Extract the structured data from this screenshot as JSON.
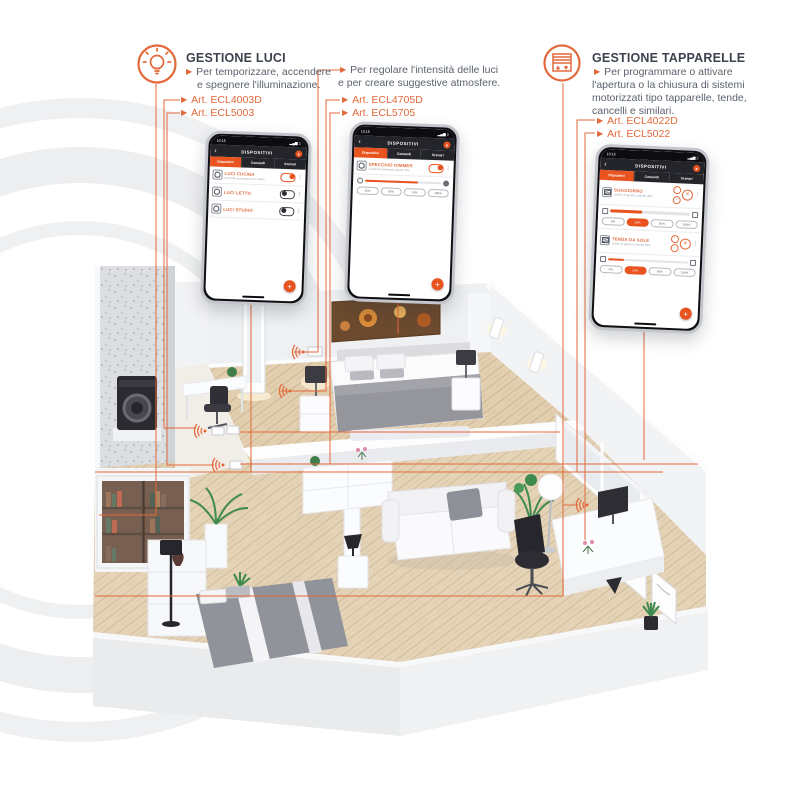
{
  "colors": {
    "accent": "#e2693b",
    "app_orange": "#e8531f",
    "dark_ui": "#24252b"
  },
  "callout_luci": {
    "title": "GESTIONE LUCI",
    "line1": "Per temporizzare, accendere",
    "line2": "e spegnere l'illuminazione.",
    "articles": [
      "Art. ECL4003D",
      "Art. ECL5003"
    ]
  },
  "callout_dimmer": {
    "line1": "Per regolare l'intensità delle luci",
    "line2": "e per creare suggestive atmosfere.",
    "articles": [
      "Art. ECL4705D",
      "Art. ECL5705"
    ]
  },
  "callout_tapparelle": {
    "title": "GESTIONE TAPPARELLE",
    "line1": "Per programmare o attivare",
    "line2": "l'apertura o la chiusura di sistemi",
    "line3": "motorizzati tipo tapparelle, tende,",
    "line4": "cancelli e similari.",
    "articles": [
      "Art. ECL4022D",
      "Art. ECL5022"
    ]
  },
  "phone_common": {
    "time": "10:15",
    "status_icons": "▂▄▆ ▯",
    "back": "‹",
    "title": "DISPOSITIVI",
    "tabs": [
      "Dispositivi",
      "Comandi",
      "Scenari"
    ],
    "fab": "+",
    "kebab": "⋮"
  },
  "phone_luci": {
    "rows": [
      {
        "label": "LUCI CUCINA",
        "sub": "Controllo accensione luci 100%",
        "state": "on"
      },
      {
        "label": "LUCI LETTO",
        "sub": "",
        "state": "off"
      },
      {
        "label": "LUCI STUDIO",
        "sub": "",
        "state": "off"
      }
    ]
  },
  "phone_dimmer": {
    "row": {
      "label": "SPECCHIO DIMMER",
      "sub": "Livello di luminosità attuale 70%",
      "state": "on"
    },
    "level_pct": 70,
    "presets": [
      "25%",
      "50%",
      "75%",
      "100%"
    ]
  },
  "phone_tapparelle": {
    "up": "↑",
    "down": "↓",
    "stop": "✕",
    "presets": [
      "0%",
      "25%",
      "50%",
      "100%"
    ],
    "rows": [
      {
        "label": "SOGGIORNO",
        "sub": "Livello di apertura attuale 40%",
        "level_pct": 40,
        "active_preset": 1
      },
      {
        "label": "TENDA DA SOLE",
        "sub": "Livello di apertura attuale 20%",
        "level_pct": 20,
        "active_preset": 1
      }
    ]
  }
}
